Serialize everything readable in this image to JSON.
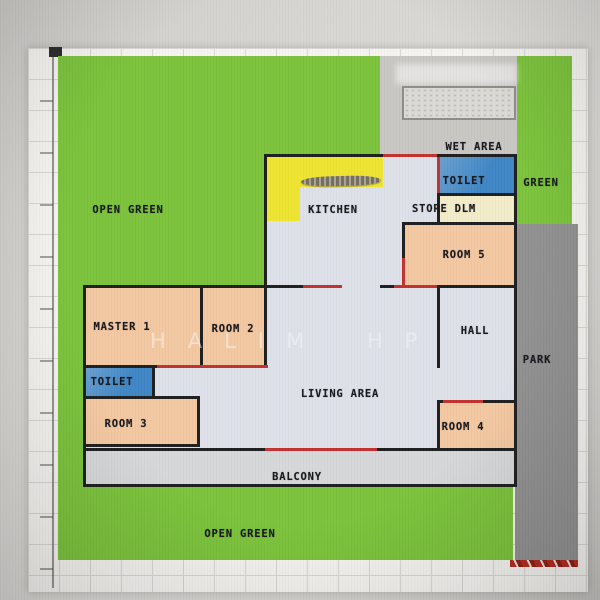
{
  "plan": {
    "watermark": "HALIM HP",
    "labels": {
      "open_green_top": "OPEN GREEN",
      "wet_area": "WET AREA",
      "toilet_top": "TOILET",
      "green_side": "GREEN",
      "kitchen": "KITCHEN",
      "store": "STORE DLM",
      "room5": "ROOM 5",
      "hall": "HALL",
      "park": "PARK",
      "master1": "MASTER 1",
      "room2": "ROOM 2",
      "toilet2": "TOILET",
      "room3": "ROOM 3",
      "living": "LIVING AREA",
      "room4": "ROOM 4",
      "balcony": "BALCONY",
      "open_green_bottom": "OPEN GREEN"
    },
    "colors": {
      "open_green": "#7cc33c",
      "room_peach": "#f3c8a2",
      "toilet_blue": "#3f86c5",
      "store_cream": "#f2ecca",
      "counter_yellow": "#eee430",
      "park_gray": "#919191",
      "wet_gray": "#c9c7c4",
      "interior_gray": "#dde1e9",
      "balcony_gray": "#d6d7d9",
      "door_red": "#c23230",
      "wall_black": "#1f1f1f",
      "canvas_bg": "#f5f4f1",
      "grid_line": "#d9d7d3"
    }
  }
}
